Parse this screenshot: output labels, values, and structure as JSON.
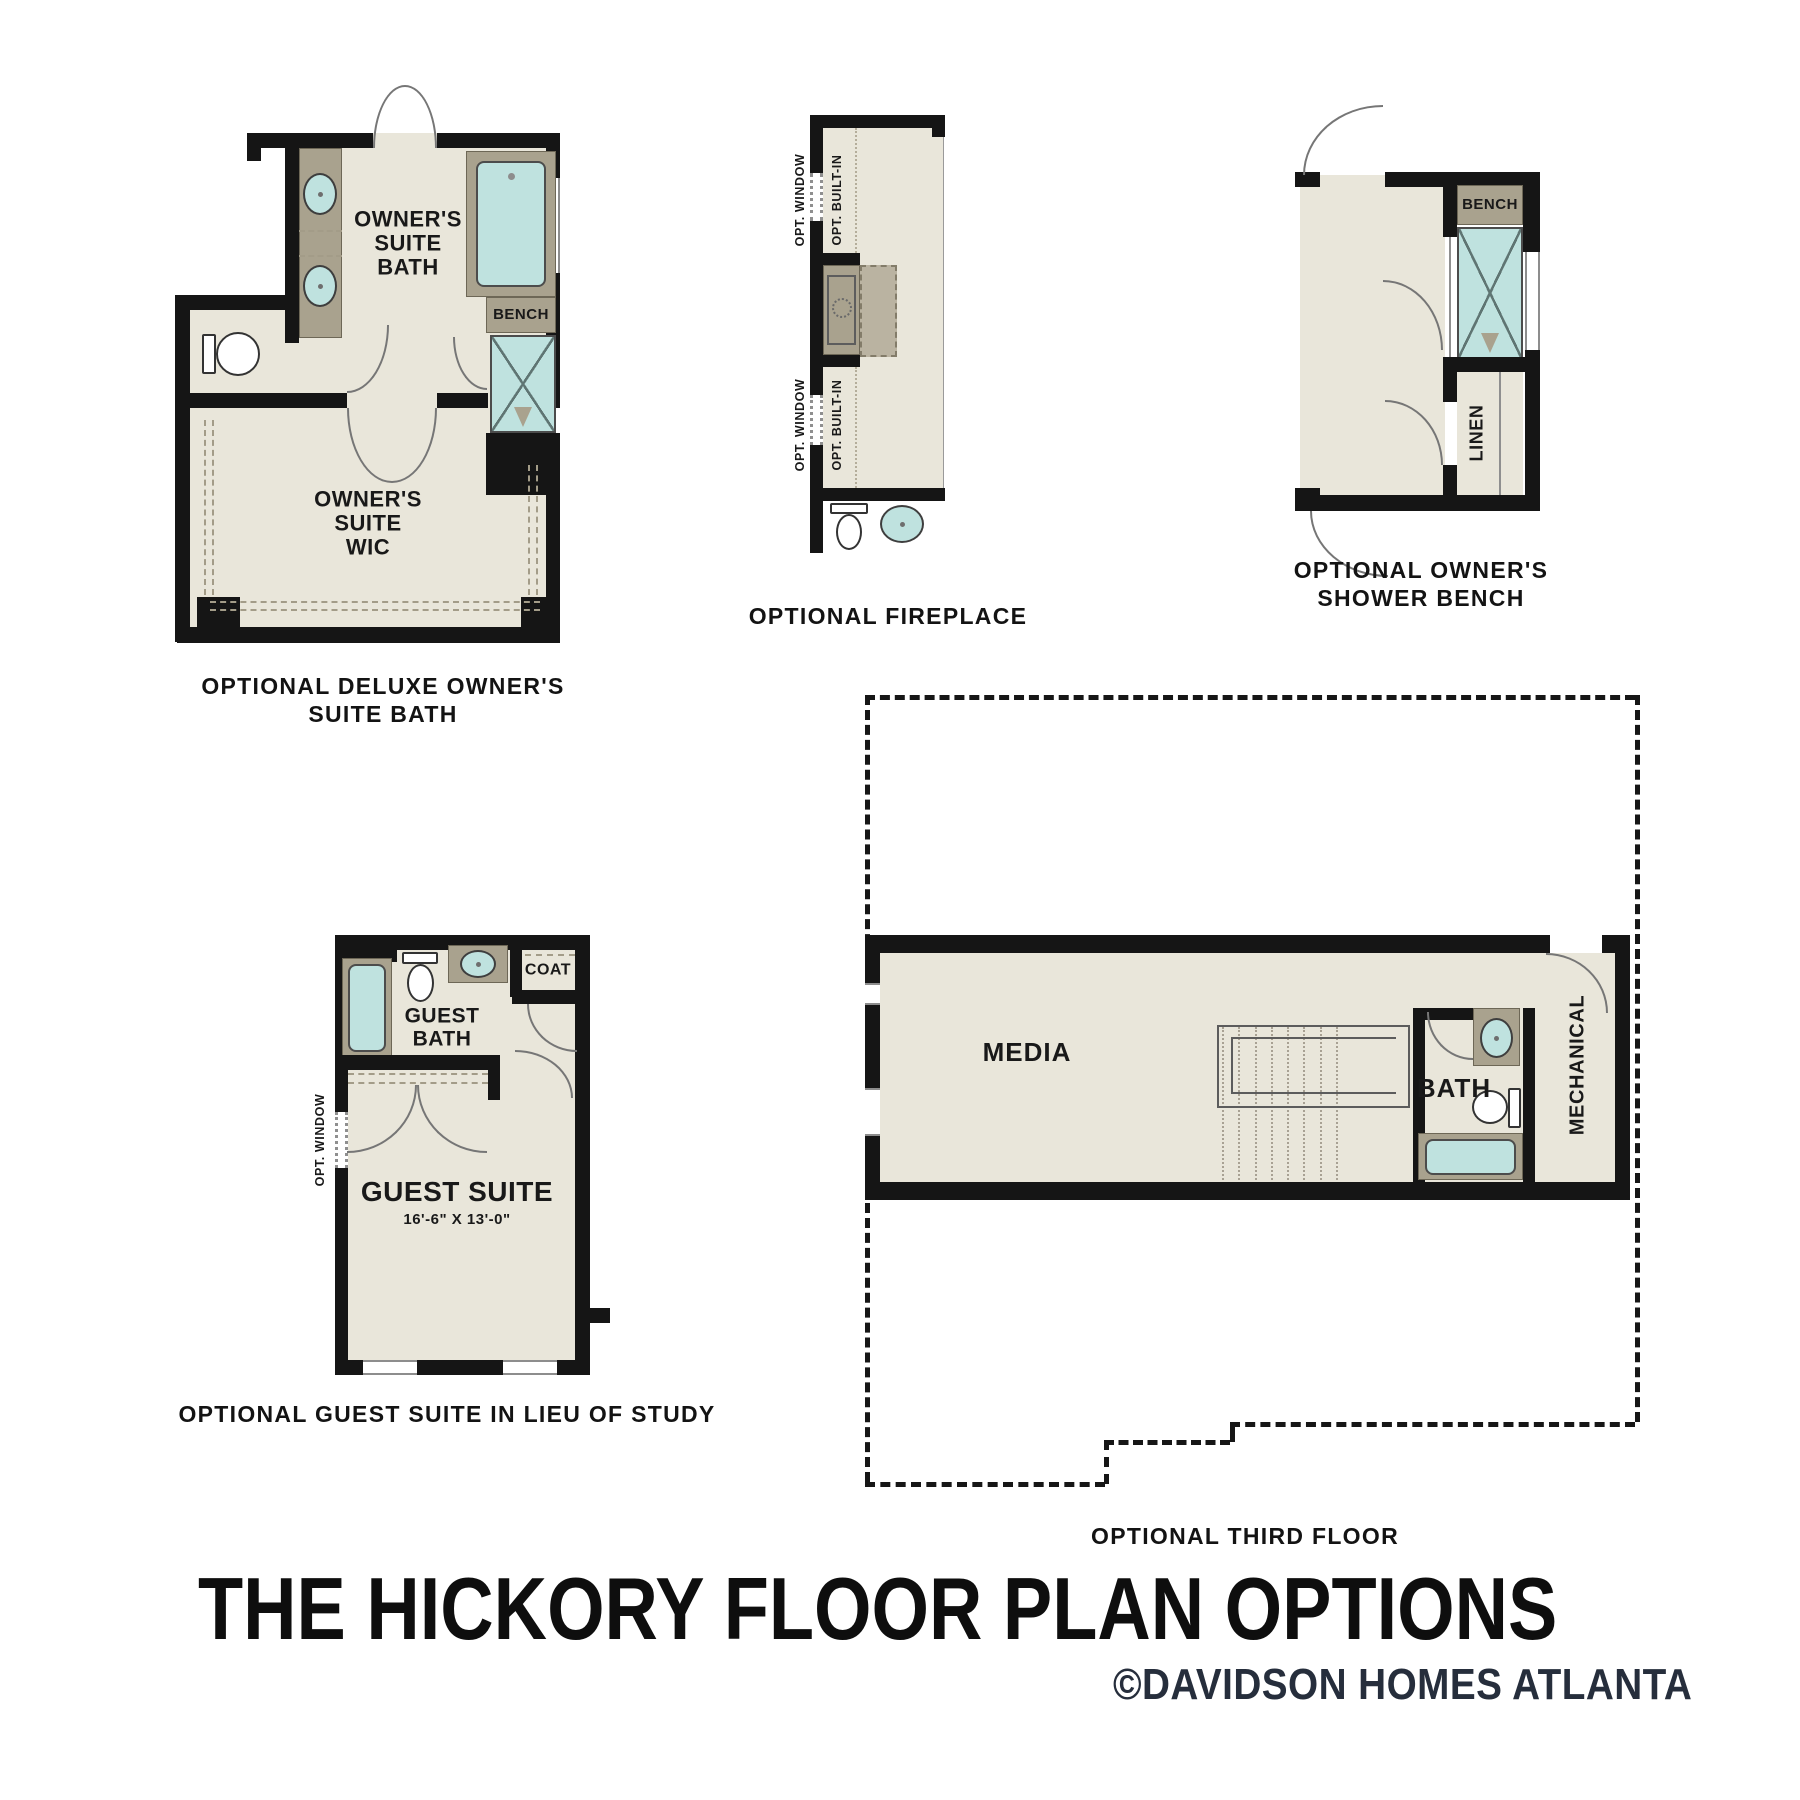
{
  "page": {
    "title": "THE HICKORY FLOOR PLAN OPTIONS",
    "copyright": "©DAVIDSON HOMES ATLANTA"
  },
  "colors": {
    "wall": "#151515",
    "room_fill": "#e9e6da",
    "fixture_tan": "#a9a28e",
    "water_teal": "#bfe2df",
    "copyright_navy": "#262e3c"
  },
  "plans": {
    "deluxe": {
      "caption": [
        "OPTIONAL DELUXE OWNER'S",
        "SUITE BATH"
      ],
      "bath_label": [
        "OWNER'S",
        "SUITE",
        "BATH"
      ],
      "wic_label": [
        "OWNER'S",
        "SUITE",
        "WIC"
      ],
      "bench_label": "BENCH"
    },
    "fireplace": {
      "caption": "OPTIONAL FIREPLACE",
      "opt_window": "OPT. WINDOW",
      "opt_builtin": "OPT. BUILT-IN"
    },
    "shower_bench": {
      "caption": [
        "OPTIONAL OWNER'S",
        "SHOWER BENCH"
      ],
      "bench_label": "BENCH",
      "linen_label": "LINEN"
    },
    "guest": {
      "caption": "OPTIONAL GUEST SUITE IN LIEU OF STUDY",
      "bath_label": [
        "GUEST",
        "BATH"
      ],
      "coat_label": "COAT",
      "suite_label": "GUEST SUITE",
      "suite_dims": "16'-6\" X 13'-0\"",
      "opt_window": "OPT. WINDOW"
    },
    "third": {
      "caption": "OPTIONAL THIRD FLOOR",
      "media_label": "MEDIA",
      "bath_label": "BATH",
      "mechanical_label": "MECHANICAL"
    }
  }
}
